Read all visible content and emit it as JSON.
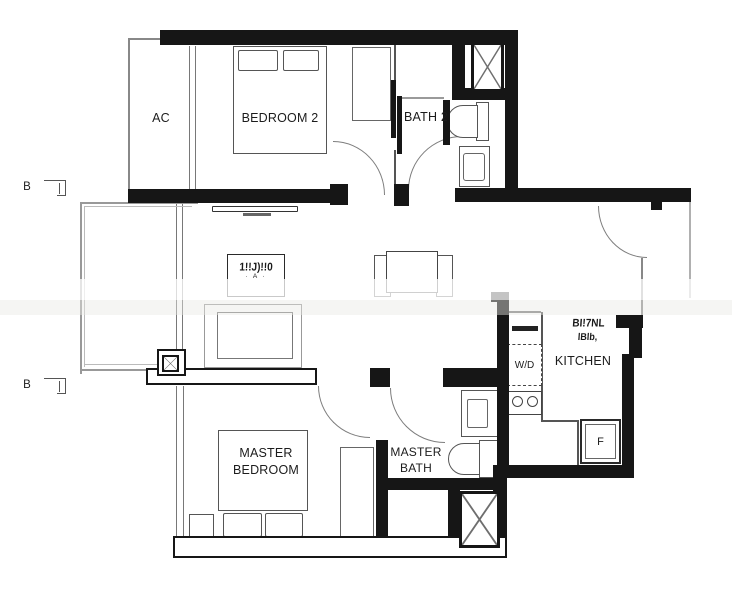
{
  "plan": {
    "title": "apartment-floor-plan",
    "rooms": {
      "ac": "AC",
      "bedroom2": "BEDROOM 2",
      "bath2": "BATH 2",
      "kitchen": "KITCHEN",
      "master_bedroom": {
        "line1": "MASTER",
        "line2": "BEDROOM"
      },
      "master_bath": {
        "line1": "MASTER",
        "line2": "BATH"
      }
    },
    "appliances": {
      "washer_dryer": "W/D",
      "fridge": "F"
    },
    "markers": {
      "b_top": "B",
      "b_bottom": "B"
    },
    "artifacts": {
      "living_box_line1": "1!!J)!!0",
      "living_box_line2": "· A ·",
      "kitchen_text_line1": "BI!7NL",
      "kitchen_text_line2": "lBlb,"
    },
    "colors": {
      "wall": "#161616",
      "line": "#555555",
      "light_line": "#9a9a9a",
      "label": "#1c1c1c",
      "background": "#ffffff"
    }
  }
}
